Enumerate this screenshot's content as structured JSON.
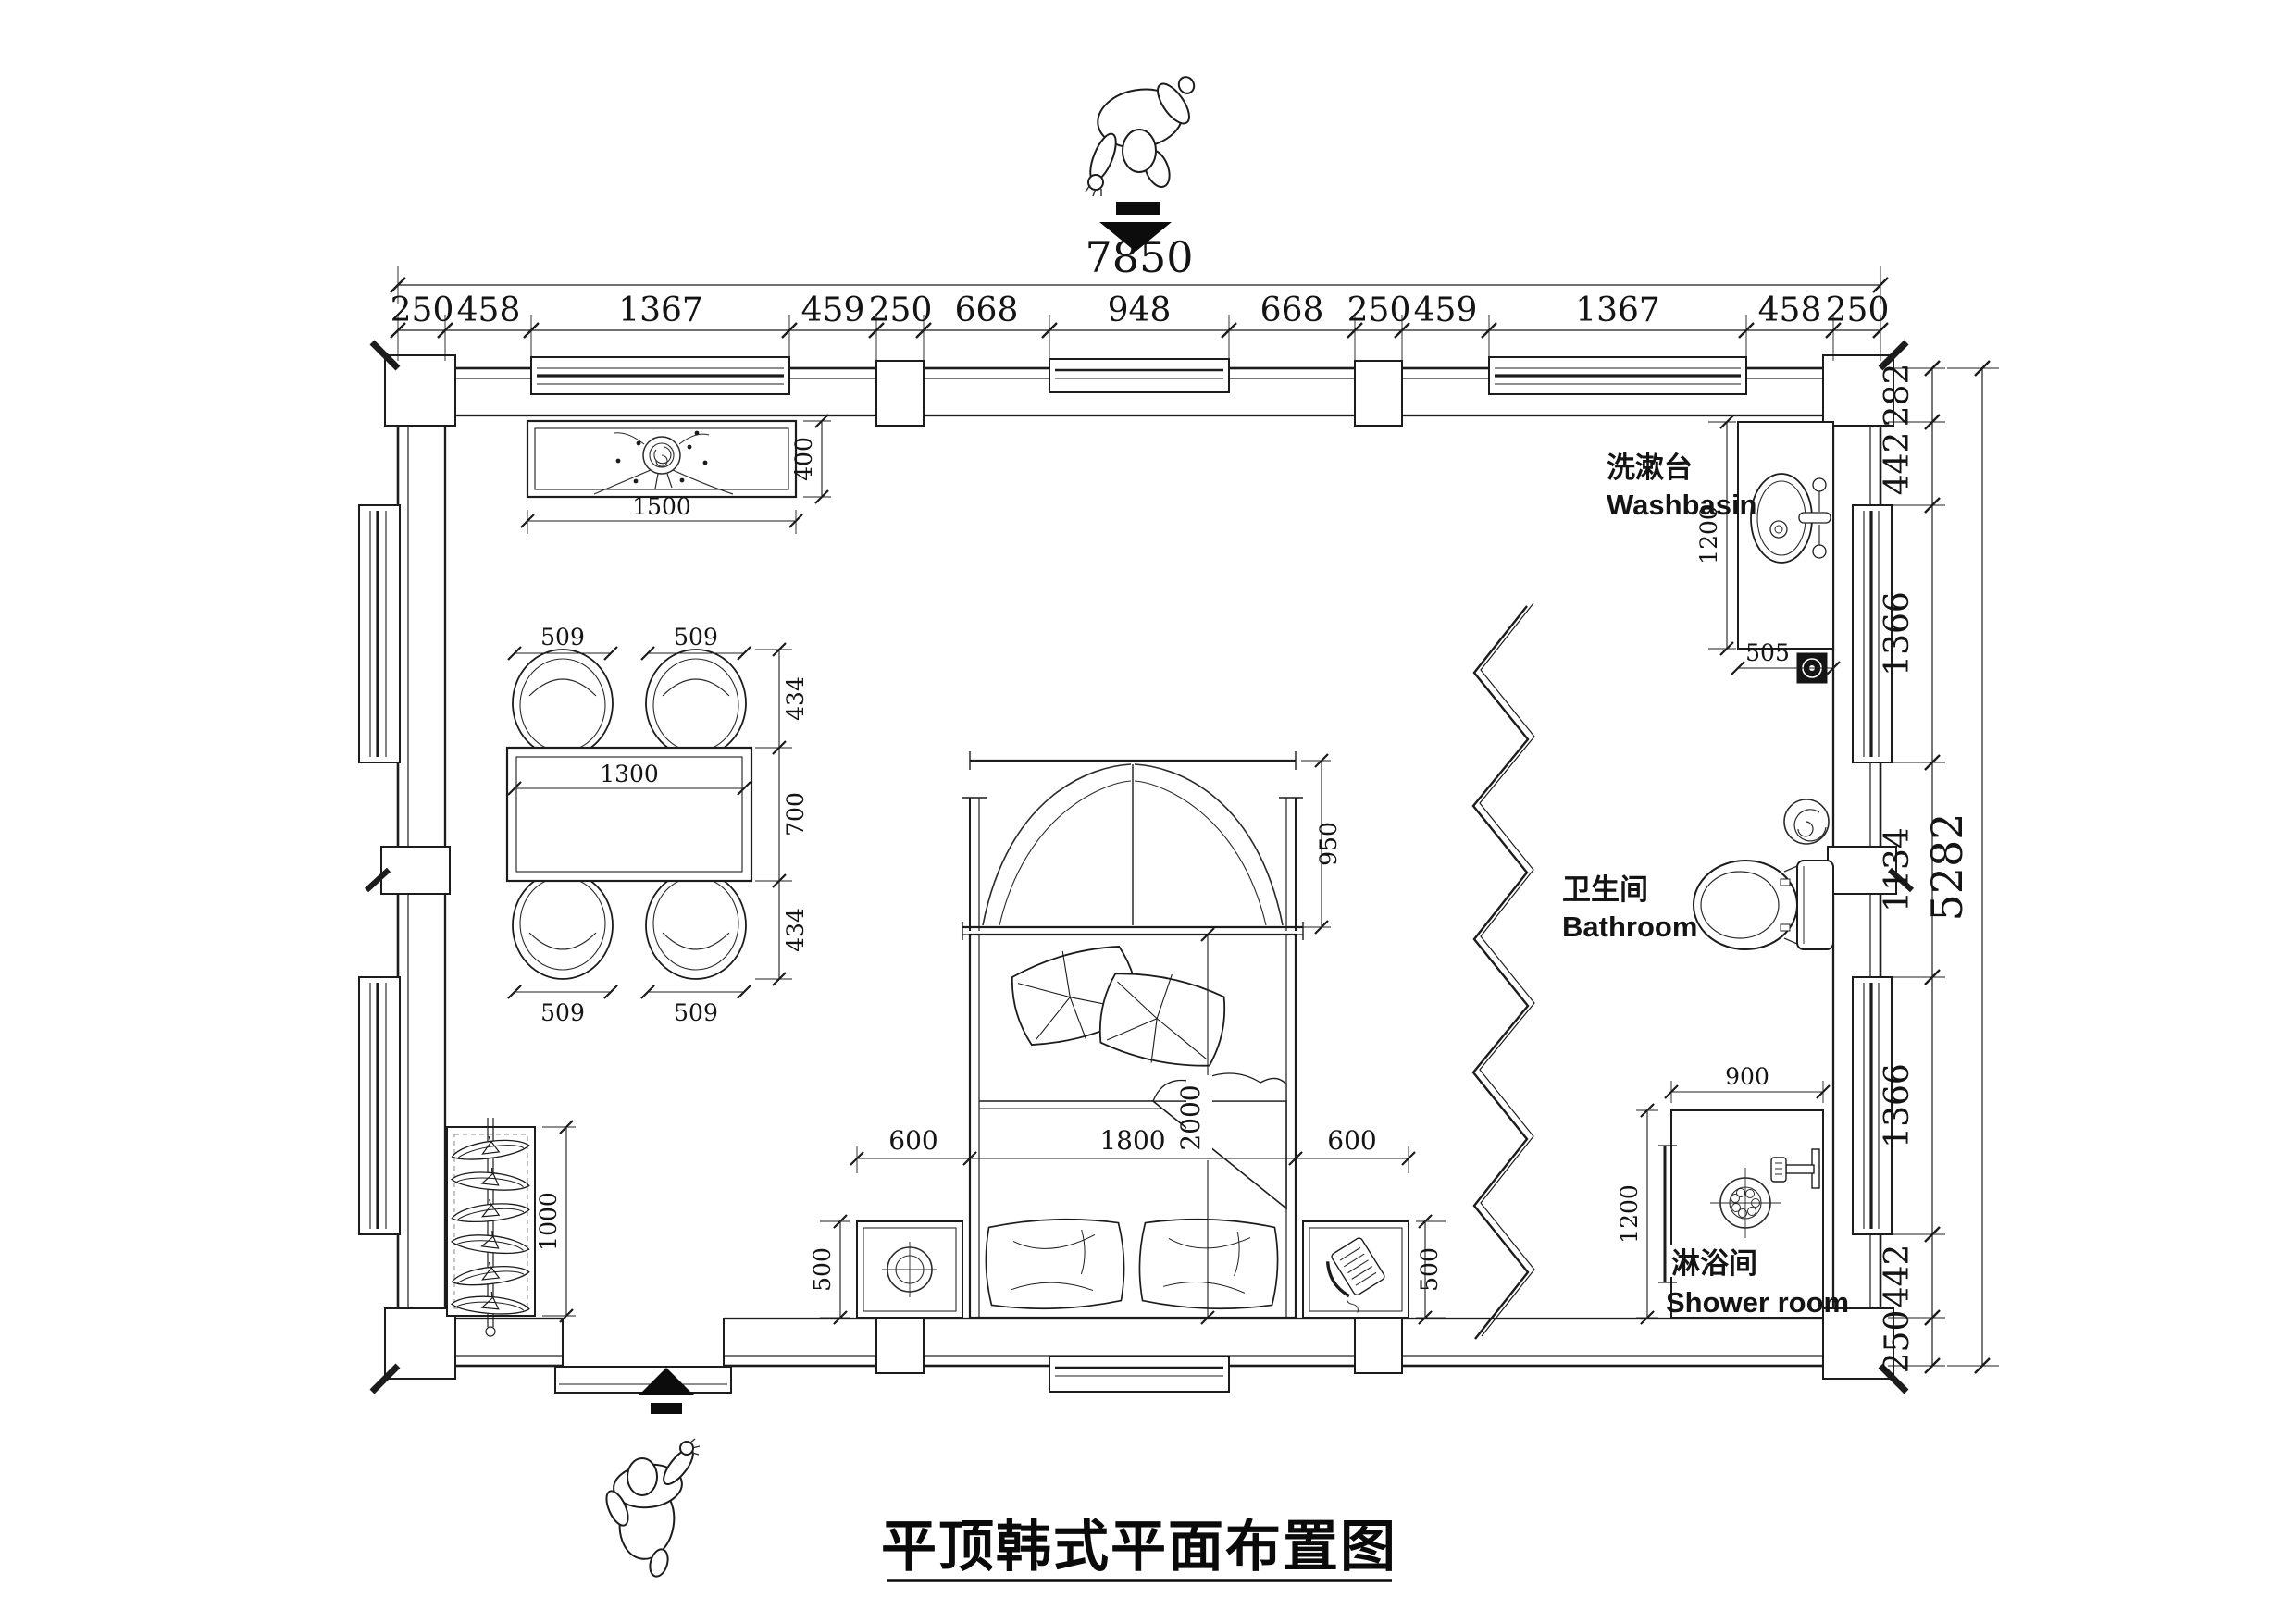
{
  "title": "平顶韩式平面布置图",
  "dimensions": {
    "top_total": "7850",
    "top_chain": [
      "250",
      "458",
      "1367",
      "459",
      "250",
      "668",
      "948",
      "668",
      "250",
      "459",
      "1367",
      "458",
      "250"
    ],
    "right_total": "5282",
    "right_chain": [
      "282",
      "442",
      "1366",
      "1134",
      "1366",
      "442",
      "250"
    ]
  },
  "rooms": {
    "washbasin": {
      "zh": "洗漱台",
      "en": "Washbasin"
    },
    "bathroom": {
      "zh": "卫生间",
      "en": "Bathroom"
    },
    "shower": {
      "zh": "淋浴间",
      "en": "Shower room"
    }
  },
  "furniture_dims": {
    "tv_cabinet": {
      "width": "1500",
      "depth": "400"
    },
    "dining": {
      "chair_width": "509",
      "chair_depth": "434",
      "table_depth": "700",
      "table_width": "1300"
    },
    "bed": {
      "side_gap": "600",
      "width": "1800",
      "length": "2000",
      "headboard_depth": "950"
    },
    "nightstand_depth": "500",
    "clothes_rack_length": "1000",
    "washbasin_counter": {
      "length": "1200",
      "width": "505"
    },
    "shower_room": {
      "width": "900",
      "depth": "1200"
    }
  }
}
